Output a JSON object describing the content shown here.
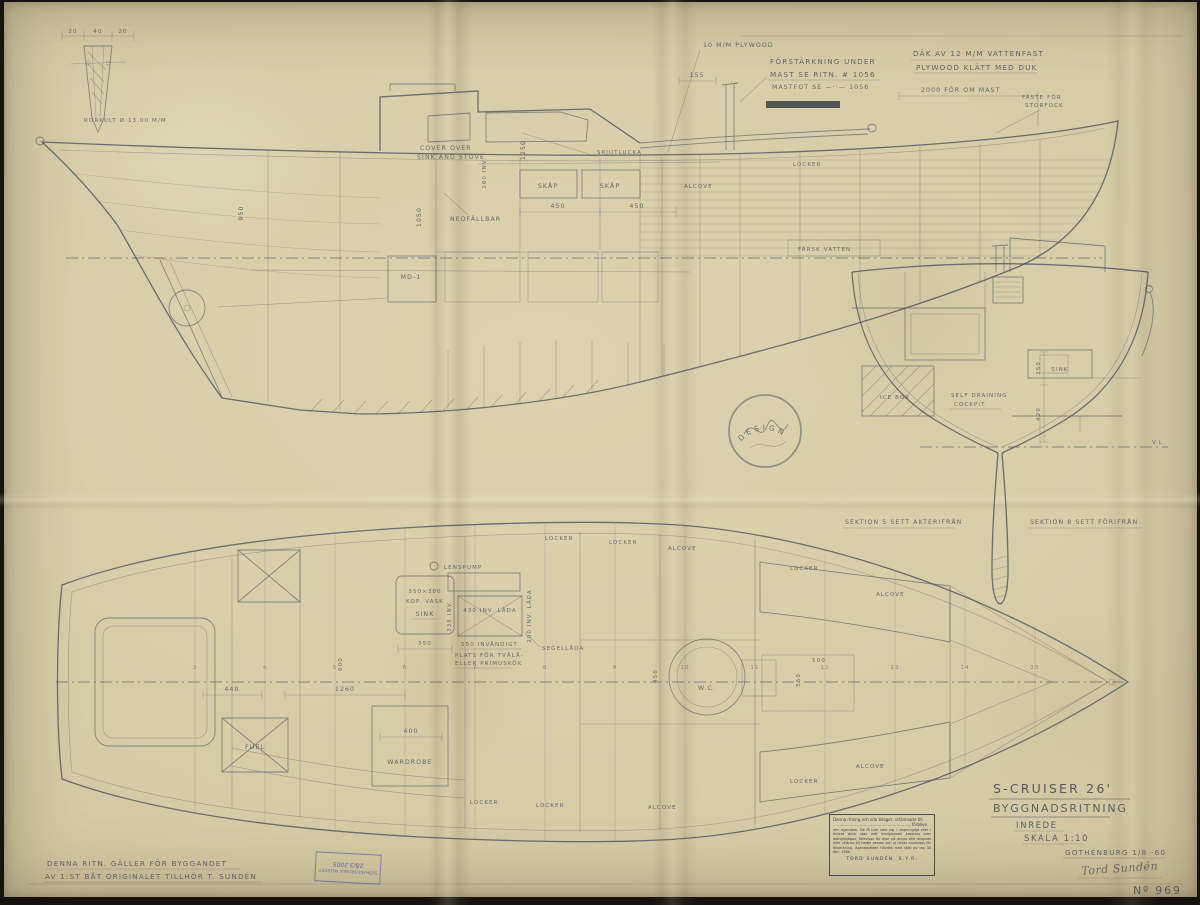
{
  "colors": {
    "paper": "#d6cca7",
    "ink": "#4b5160",
    "stamp_blue": "#5565a8",
    "stamp_black": "#3a3d47"
  },
  "sheet": {
    "number": "Nº 969"
  },
  "title_block": {
    "boat": "S-CRUISER 26'",
    "doc_type": "BYGGNADSRITNING",
    "subtitle": "INREDE",
    "scale": "SKALA 1:10",
    "place_date": "GOTHENBURG 1/8 -60",
    "signature": "Tord Sundén"
  },
  "top_notes": {
    "plywood": "10 M/M PLYWOOD",
    "reinforce1": "FÖRSTÄRKNING UNDER",
    "reinforce2": "MAST SE RITN. # 1056",
    "reinforce3": "MASTFOT SE  —··—  1056",
    "deck1": "DÄK AV 12 M/M VATTENFAST",
    "deck2": "PLYWOOD KLÄTT MED DUK",
    "mast_pos": "2000 FÖR OM MAST",
    "cleat1": "FÄSTE FÖR",
    "cleat2": "STORFOCK",
    "dim155": "155"
  },
  "tiller_detail": {
    "d1": "20",
    "d2": "40",
    "d3": "20",
    "caption": "RORKULT Ø 13.00 M/M"
  },
  "profile": {
    "cover1": "COVER OVER",
    "cover2": "SINK AND STOVE",
    "skjutlucka": "SKJUTLUCKA",
    "skap1": "SKÅP",
    "skap2": "SKÅP",
    "nedfallbar": "NEDFÄLLBAR",
    "locker": "LOCKER",
    "alcove": "ALCOVE",
    "farskvatten": "FÄRSK VATTEN",
    "engine": "MD-1",
    "d450a": "450",
    "d450b": "450",
    "d1250": "1250",
    "d1050": "1050",
    "d950": "950",
    "d180": "180 INV."
  },
  "sections": {
    "label5": "SEKTION 5 SETT AKTERIFRÅN",
    "label8": "SEKTION 8 SETT FÖRIFRÅN",
    "icebox": "ICE BOX",
    "cockpit1": "SELF DRAINING",
    "cockpit2": "COCKPIT",
    "sink": "SINK",
    "d250": "250",
    "d420": "420",
    "waterline": "V.L."
  },
  "plan": {
    "lenspump": "LENSPUMP",
    "sink1": "350×380",
    "sink2": "KOP. VASK",
    "sink3": "SINK",
    "inv335": "335 INV.",
    "lada430": "430 INV. LÅDA",
    "lada200": "200 INV. LÅDA",
    "inv550": "550 INVÄNDIGT",
    "plats1": "PLATS FÖR TVÅLÅ-",
    "plats2": "ELLER PRIMUSKÖK",
    "segellada": "SEGELLÅDA",
    "wc": "W.C.",
    "fuel": "FUEL",
    "wardrobe": "WARDROBE",
    "locker_t1": "LOCKER",
    "locker_t2": "LOCKER",
    "alcove_t1": "ALCOVE",
    "locker_t3": "LOCKER",
    "alcove_t2": "ALCOVE",
    "locker_b1": "LOCKER",
    "locker_b2": "LOCKER",
    "alcove_b1": "ALCOVE",
    "locker_b3": "LOCKER",
    "alcove_b2": "ALCOVE",
    "d1260": "1260",
    "d440": "440",
    "d400": "400",
    "d450": "450",
    "d500": "500",
    "d550": "550",
    "d600": "600",
    "d350": "350",
    "stations": [
      "3",
      "4",
      "5",
      "6",
      "7",
      "8",
      "9",
      "10",
      "11",
      "12",
      "13",
      "14",
      "15"
    ]
  },
  "design_stamp": {
    "word": "DESIGN"
  },
  "ownership_note": {
    "line1": "DENNA RITN. GÄLLER FÖR BYGGANDET",
    "line2": "AV 1:ST BÅT   ORIGINALET TILLHÖR T. SUNDÉN"
  },
  "legal_stamp": {
    "line1": "Denna ritning och alla bilagor, utlämnade till",
    "line2": "............................................................, förblive",
    "body": "min egendom. De få icke vare sig i ursprungligt eller i ändrat skick utan mitt medgivande kopieras eller mångfaldigas, förevisas för eller på annat sätt delgivas eller utlånas till tredje person och ej heller användas för tillverkning. Äganderätten hävdes med stöd av lag 30 dec. 1960.",
    "footer": "TORD SUNDÉN. S.Y.R."
  },
  "museum_stamp": {
    "line1": "SJÖHISTORISKA MUSEET",
    "line2": "28/3 2005"
  }
}
